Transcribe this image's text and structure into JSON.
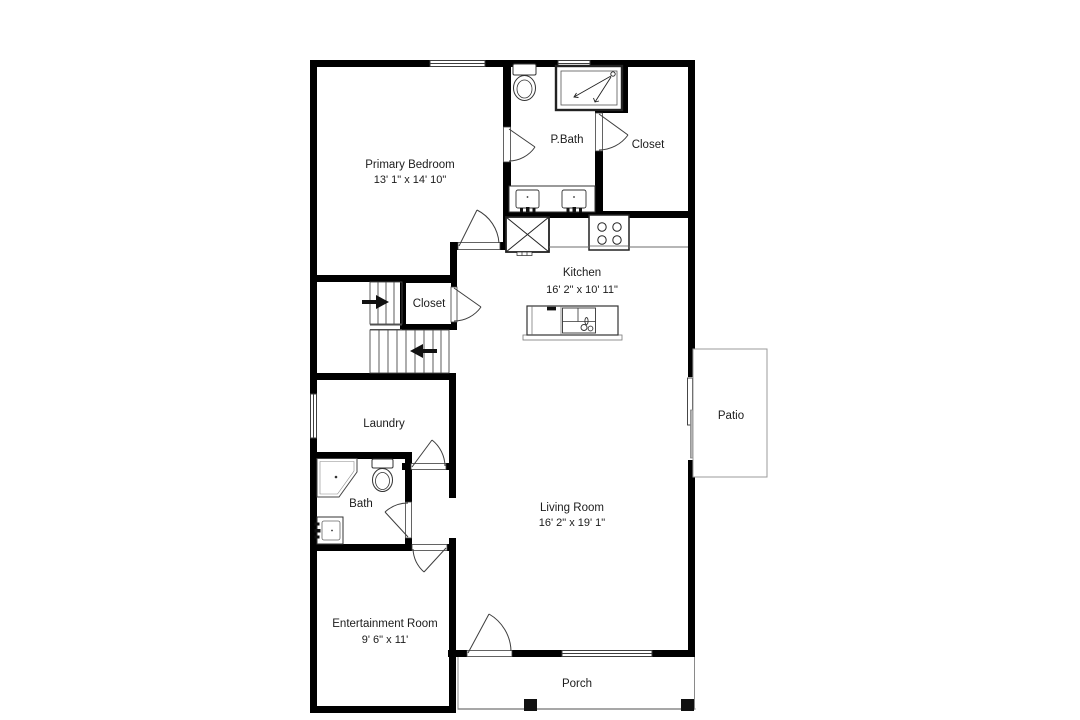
{
  "title": "Floor plan",
  "colors": {
    "background": "#ffffff",
    "wall": "#000000",
    "fixture_line": "#3d3d3d",
    "light_line": "#8f8f8f",
    "text": "#1c1c1c"
  },
  "rooms": {
    "primary_bedroom": {
      "name": "Primary Bedroom",
      "dims": "13' 1\" x 14' 10\""
    },
    "p_bath": {
      "name": "P.Bath"
    },
    "closet_main": {
      "name": "Closet"
    },
    "closet_stairs": {
      "name": "Closet"
    },
    "kitchen": {
      "name": "Kitchen",
      "dims": "16' 2\" x 10' 11\""
    },
    "laundry": {
      "name": "Laundry"
    },
    "bath": {
      "name": "Bath"
    },
    "living_room": {
      "name": "Living Room",
      "dims": "16' 2\" x 19' 1\""
    },
    "entertainment_room": {
      "name": "Entertainment Room",
      "dims": "9' 6\" x 11'"
    },
    "patio": {
      "name": "Patio"
    },
    "porch": {
      "name": "Porch"
    }
  }
}
